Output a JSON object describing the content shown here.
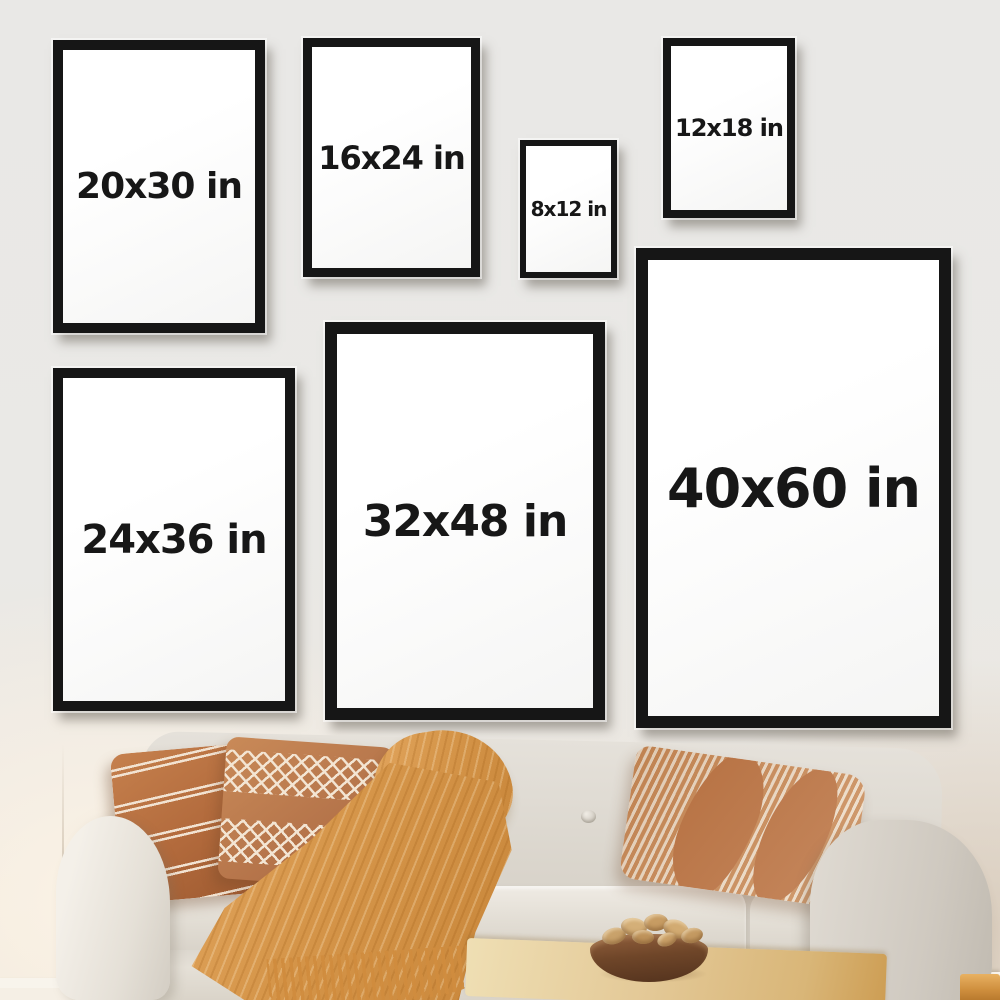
{
  "frames": [
    {
      "name": "20x30",
      "label": "20x30 in"
    },
    {
      "name": "16x24",
      "label": "16x24 in"
    },
    {
      "name": "8x12",
      "label": "8x12 in"
    },
    {
      "name": "12x18",
      "label": "12x18 in"
    },
    {
      "name": "24x36",
      "label": "24x36 in"
    },
    {
      "name": "32x48",
      "label": "32x48 in"
    },
    {
      "name": "40x60",
      "label": "40x60 in"
    }
  ],
  "palette": {
    "c-frame": "#161616",
    "c-mat": "#ffffff",
    "c-label": "#171717",
    "c-wall": "#e9e8e6",
    "c-sofa": "#ddd8cf",
    "c-rust": "#b26a3c",
    "c-mustard": "#d59549",
    "c-wood": "#e3c896",
    "c-bowl": "#6f4629"
  }
}
